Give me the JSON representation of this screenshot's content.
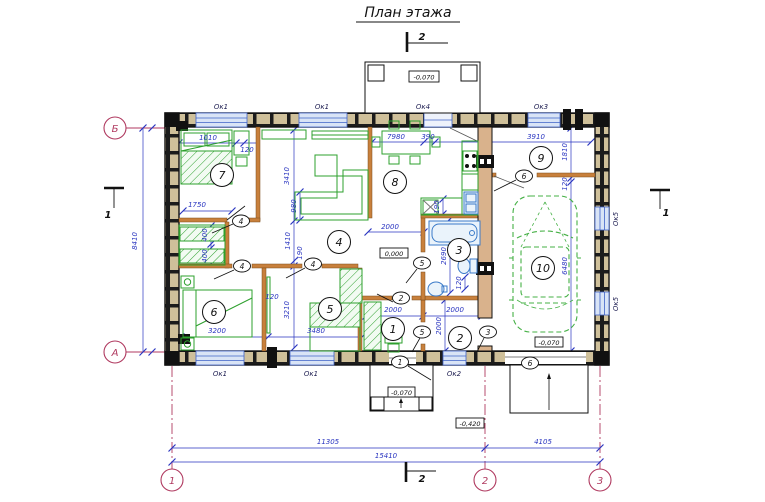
{
  "title": "План этажа",
  "axes": {
    "bottom": [
      "1",
      "2",
      "3"
    ],
    "left_top": "Б",
    "left_bottom": "А"
  },
  "sections": {
    "s1": "1",
    "s2": "2"
  },
  "rooms": [
    "1",
    "2",
    "3",
    "4",
    "5",
    "6",
    "7",
    "8",
    "9",
    "10"
  ],
  "door_tags": {
    "t1": "1",
    "t2": "2",
    "t3": "3",
    "t4": "4",
    "t5": "5",
    "t6": "6"
  },
  "windows": {
    "ok1": "Ок1",
    "ok2": "Ок2",
    "ok3": "Ок3",
    "ok4": "Ок4",
    "ok5": "Ок5"
  },
  "elevations": {
    "porch_top": "-0,070",
    "floor": "0,000",
    "garage": "-0,070",
    "porch_bottom": "-0,070",
    "apron": "-0,420"
  },
  "dims": {
    "total": "15410",
    "left_span": "11305",
    "right_span": "4105",
    "height": "8410",
    "k7980": "7980",
    "k390": "390",
    "k3910": "3910",
    "k1810": "1810",
    "k120wall": "120",
    "k6480": "6480",
    "k1010": "1010",
    "k120a": "120",
    "k1750": "1750",
    "k400a": "400",
    "k400b": "400",
    "k3410": "3410",
    "k1410": "1410",
    "k190a": "190",
    "k980": "980",
    "k3210": "3210",
    "k2000hall": "2000",
    "k190k": "190",
    "k2690": "2690",
    "k120wc": "120",
    "k3200": "3200",
    "k120m": "120",
    "k3480": "3480",
    "k2000r1": "2000",
    "k2000r2": "2000",
    "k2000v": "2000"
  },
  "colors": {
    "dimension_blue": "#2a35c0",
    "axis_red": "#b03a60",
    "furniture_green": "#2da02d",
    "sanitary_blue": "#3a7ac8",
    "wall_block_tan": "#cfc09a",
    "bearing_wall_tan": "#d9b28c",
    "partition_orange": "#c8803c",
    "window_fill": "#d9e4f6"
  }
}
